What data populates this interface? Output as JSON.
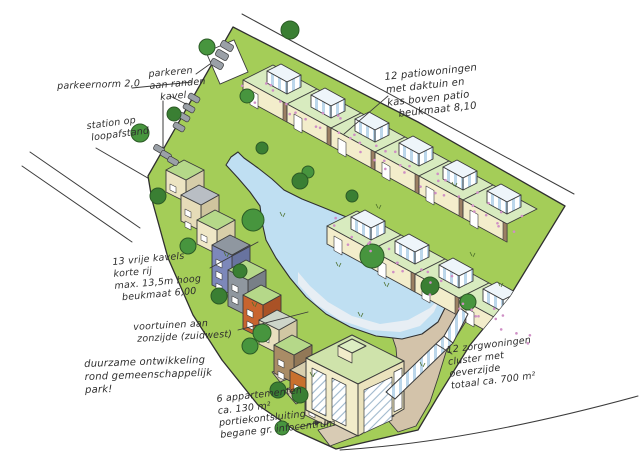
{
  "annotations": {
    "parking_norm": "parkeernorm 2,0",
    "parking_edges": "parkeren\naan randen\n   kavel",
    "station": "station op\n loopafstand",
    "patio_houses": "12 patiowoningen\nmet daktuin en\nkas boven patio\n   beukmaat 8,10",
    "free_plots": "13 vrije kavels\nkorte rij\nmax. 13,5m hoog\n  beukmaat 6,00",
    "front_gardens": "voortuinen aan\n zonzijde (zuidwest)",
    "sustainable": "duurzame ontwikkeling\nrond gemeenschappelijk\npark!",
    "apartments": "6 appartementen\nca. 130 m²\nportiekontsluiting\nbegane gr. infocentrum",
    "care_homes": "12 zorgwoningen\ncluster met\noeverzijde\ntotaal ca. 700 m²"
  },
  "palette": {
    "ink": "#3b3b3b",
    "site_green": "#a4cd58",
    "roof_garden_green": "#d8ebbf",
    "water_blue": "#bfdff2",
    "path_tan": "#d3c3aa",
    "facade_cream": "#f2ecca",
    "glass_blue": "#bcd7eb",
    "tree_green": "#47953e",
    "accent_orange": "#c8642f",
    "accent_blue": "#7d88ba",
    "flower_pink": "#cf8fc5"
  },
  "features": [
    "site-area",
    "pond",
    "patio-house-rows",
    "free-plot-row",
    "apartment-building",
    "care-cluster",
    "parking-spots",
    "trees",
    "footpath",
    "sketch-road-lines",
    "flower-dots"
  ]
}
